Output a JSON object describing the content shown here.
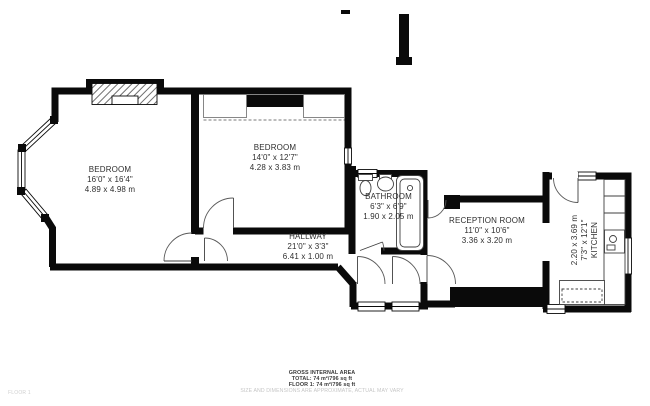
{
  "plan": {
    "rooms": [
      {
        "id": "bedroom-1",
        "name": "BEDROOM",
        "imperial": "16'0\" x 16'4\"",
        "metric": "4.89 x 4.98 m"
      },
      {
        "id": "bedroom-2",
        "name": "BEDROOM",
        "imperial": "14'0\" x 12'7\"",
        "metric": "4.28 x 3.83 m"
      },
      {
        "id": "bathroom",
        "name": "BATHROOM",
        "imperial": "6'3\" x 6'9\"",
        "metric": "1.90 x 2.05 m"
      },
      {
        "id": "hallway",
        "name": "HALLWAY",
        "imperial": "21'0\" x 3'3\"",
        "metric": "6.41 x 1.00 m"
      },
      {
        "id": "reception",
        "name": "RECEPTION ROOM",
        "imperial": "11'0\" x 10'6\"",
        "metric": "3.36 x 3.20 m"
      },
      {
        "id": "kitchen",
        "name": "KITCHEN",
        "imperial": "7'3\" x 12'1\"",
        "metric": "2.20 x 3.69 m"
      }
    ],
    "footer": {
      "gross": "GROSS INTERNAL AREA",
      "total": "TOTAL: 74 m²/796 sq ft",
      "floor": "FLOOR 1: 74 m²/796 sq ft",
      "disclaimer": "SIZE AND DIMENSIONS ARE APPROXIMATE, ACTUAL MAY VARY",
      "floor_tag": "FLOOR 1"
    },
    "colors": {
      "wall": "#0a0a0a",
      "label_text": "#2e2e2e",
      "faint_text": "#c6c6c6"
    }
  }
}
